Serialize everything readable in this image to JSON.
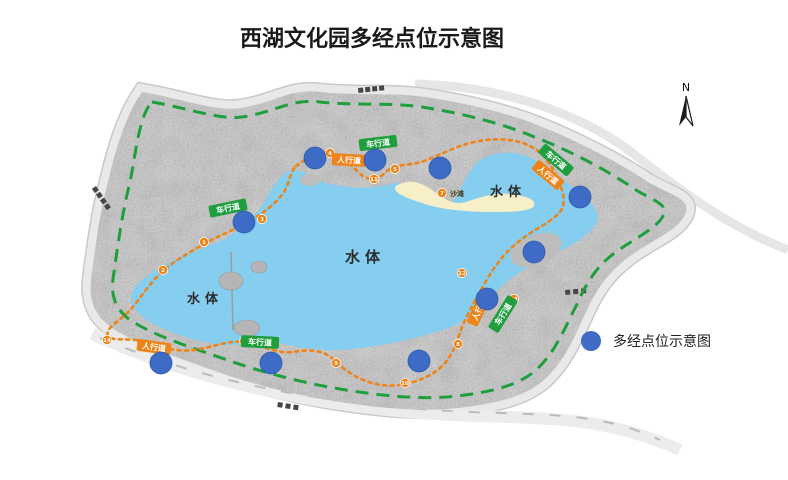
{
  "title": "西湖文化园多经点位示意图",
  "compass": {
    "label": "N"
  },
  "legend": {
    "label": "多经点位示意图"
  },
  "colors": {
    "point": "#3E6BC5",
    "point_edge": "#2F57A8",
    "vehicle_road": "#1E9E3C",
    "foot_path": "#F08318",
    "lake": "#85CEF0",
    "beach": "#F6EFC8",
    "land": "#C6C6C6",
    "road": "#E9E9E9"
  },
  "map": {
    "water_labels": [
      {
        "text": "水体",
        "x": 365,
        "y": 262,
        "size": 15
      },
      {
        "text": "水体",
        "x": 508,
        "y": 196,
        "size": 13
      },
      {
        "text": "水体",
        "x": 205,
        "y": 303,
        "size": 13
      }
    ],
    "beach_label": {
      "text": "沙滩",
      "x": 450,
      "y": 196
    },
    "vehicle_road_labels": [
      {
        "text": "车行道",
        "x": 378,
        "y": 143,
        "rot": -7
      },
      {
        "text": "车行道",
        "x": 228,
        "y": 208,
        "rot": -12
      },
      {
        "text": "车行道",
        "x": 556,
        "y": 160,
        "rot": 40
      },
      {
        "text": "车行道",
        "x": 260,
        "y": 342,
        "rot": 3
      },
      {
        "text": "车行道",
        "x": 503,
        "y": 314,
        "rot": -58
      }
    ],
    "foot_path_labels": [
      {
        "text": "人行道",
        "x": 349,
        "y": 160,
        "rot": 3
      },
      {
        "text": "人行道",
        "x": 548,
        "y": 175,
        "rot": 40
      },
      {
        "text": "人行道",
        "x": 154,
        "y": 347,
        "rot": 8
      },
      {
        "text": "人行道",
        "x": 479,
        "y": 309,
        "rot": -65
      }
    ],
    "point_radius": 11,
    "points": [
      {
        "x": 315,
        "y": 158
      },
      {
        "x": 375,
        "y": 160
      },
      {
        "x": 440,
        "y": 168
      },
      {
        "x": 580,
        "y": 197
      },
      {
        "x": 534,
        "y": 252
      },
      {
        "x": 487,
        "y": 299
      },
      {
        "x": 419,
        "y": 361
      },
      {
        "x": 271,
        "y": 363
      },
      {
        "x": 161,
        "y": 363
      },
      {
        "x": 244,
        "y": 222
      }
    ],
    "markers": [
      {
        "n": "1",
        "x": 204,
        "y": 242
      },
      {
        "n": "2",
        "x": 163,
        "y": 270
      },
      {
        "n": "3",
        "x": 262,
        "y": 219
      },
      {
        "n": "4",
        "x": 330,
        "y": 153
      },
      {
        "n": "5",
        "x": 395,
        "y": 169
      },
      {
        "n": "6",
        "x": 244,
        "y": 341
      },
      {
        "n": "7",
        "x": 442,
        "y": 193
      },
      {
        "n": "8",
        "x": 458,
        "y": 344
      },
      {
        "n": "9",
        "x": 336,
        "y": 363
      },
      {
        "n": "10",
        "x": 405,
        "y": 383
      },
      {
        "n": "11",
        "x": 374,
        "y": 179
      },
      {
        "n": "12",
        "x": 462,
        "y": 273
      },
      {
        "n": "13",
        "x": 514,
        "y": 299
      },
      {
        "n": "14",
        "x": 107,
        "y": 340
      }
    ]
  }
}
